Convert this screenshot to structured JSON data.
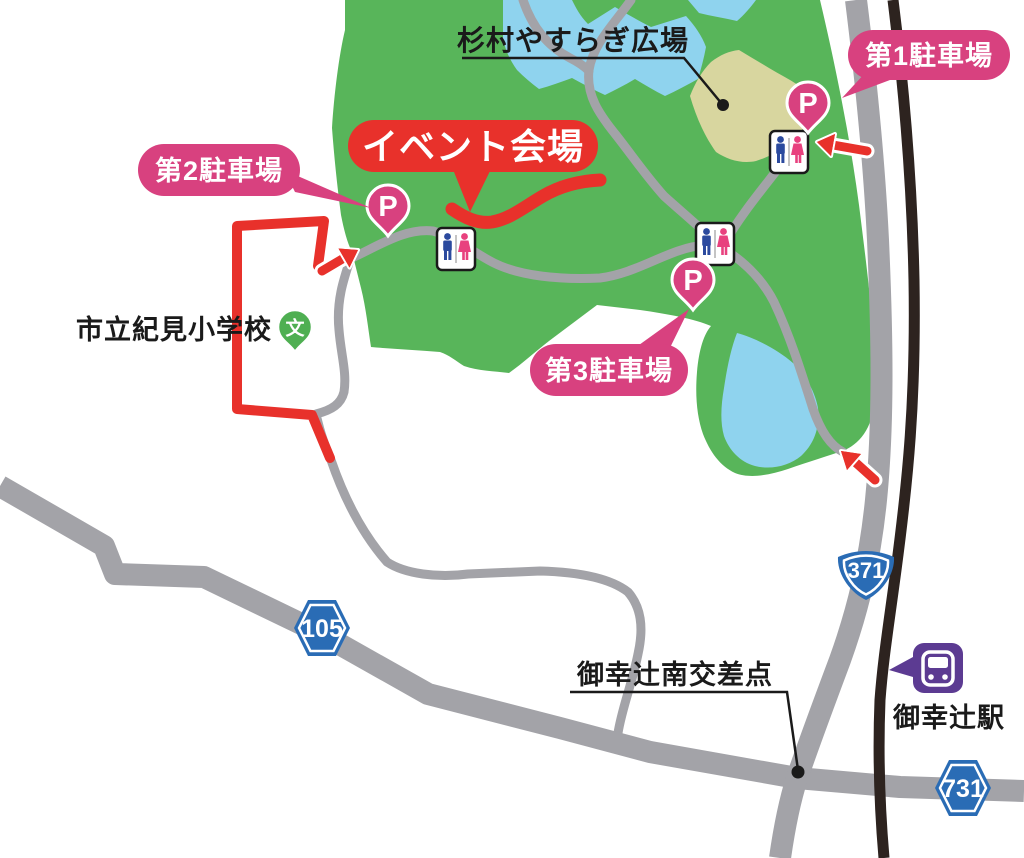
{
  "labels": {
    "plaza": "杉村やすらぎ広場",
    "event_venue": "イベント会場",
    "parking1": "第1駐車場",
    "parking2": "第2駐車場",
    "parking3": "第3駐車場",
    "school": "市立紀見小学校",
    "school_pin": "文",
    "intersection": "御幸辻南交差点",
    "station": "御幸辻駅",
    "parking_pin": "P"
  },
  "route_badges": {
    "prefectural_105": "105",
    "national_371": "371",
    "prefectural_731": "731"
  },
  "colors": {
    "park_green": "#58B55A",
    "pond_blue": "#8FD3EE",
    "field_beige": "#D8D69F",
    "road_gray": "#A3A3A8",
    "railway_dark": "#2D231F",
    "route_red": "#E8312B",
    "parking_pink": "#D8417F",
    "badge_blue": "#2A6CB5",
    "station_purple": "#5C3B92",
    "school_green": "#4FAF52",
    "toilet_man_blue": "#2B4A9E",
    "toilet_woman_pink": "#E8417E",
    "text_black": "#1A1A1A"
  }
}
